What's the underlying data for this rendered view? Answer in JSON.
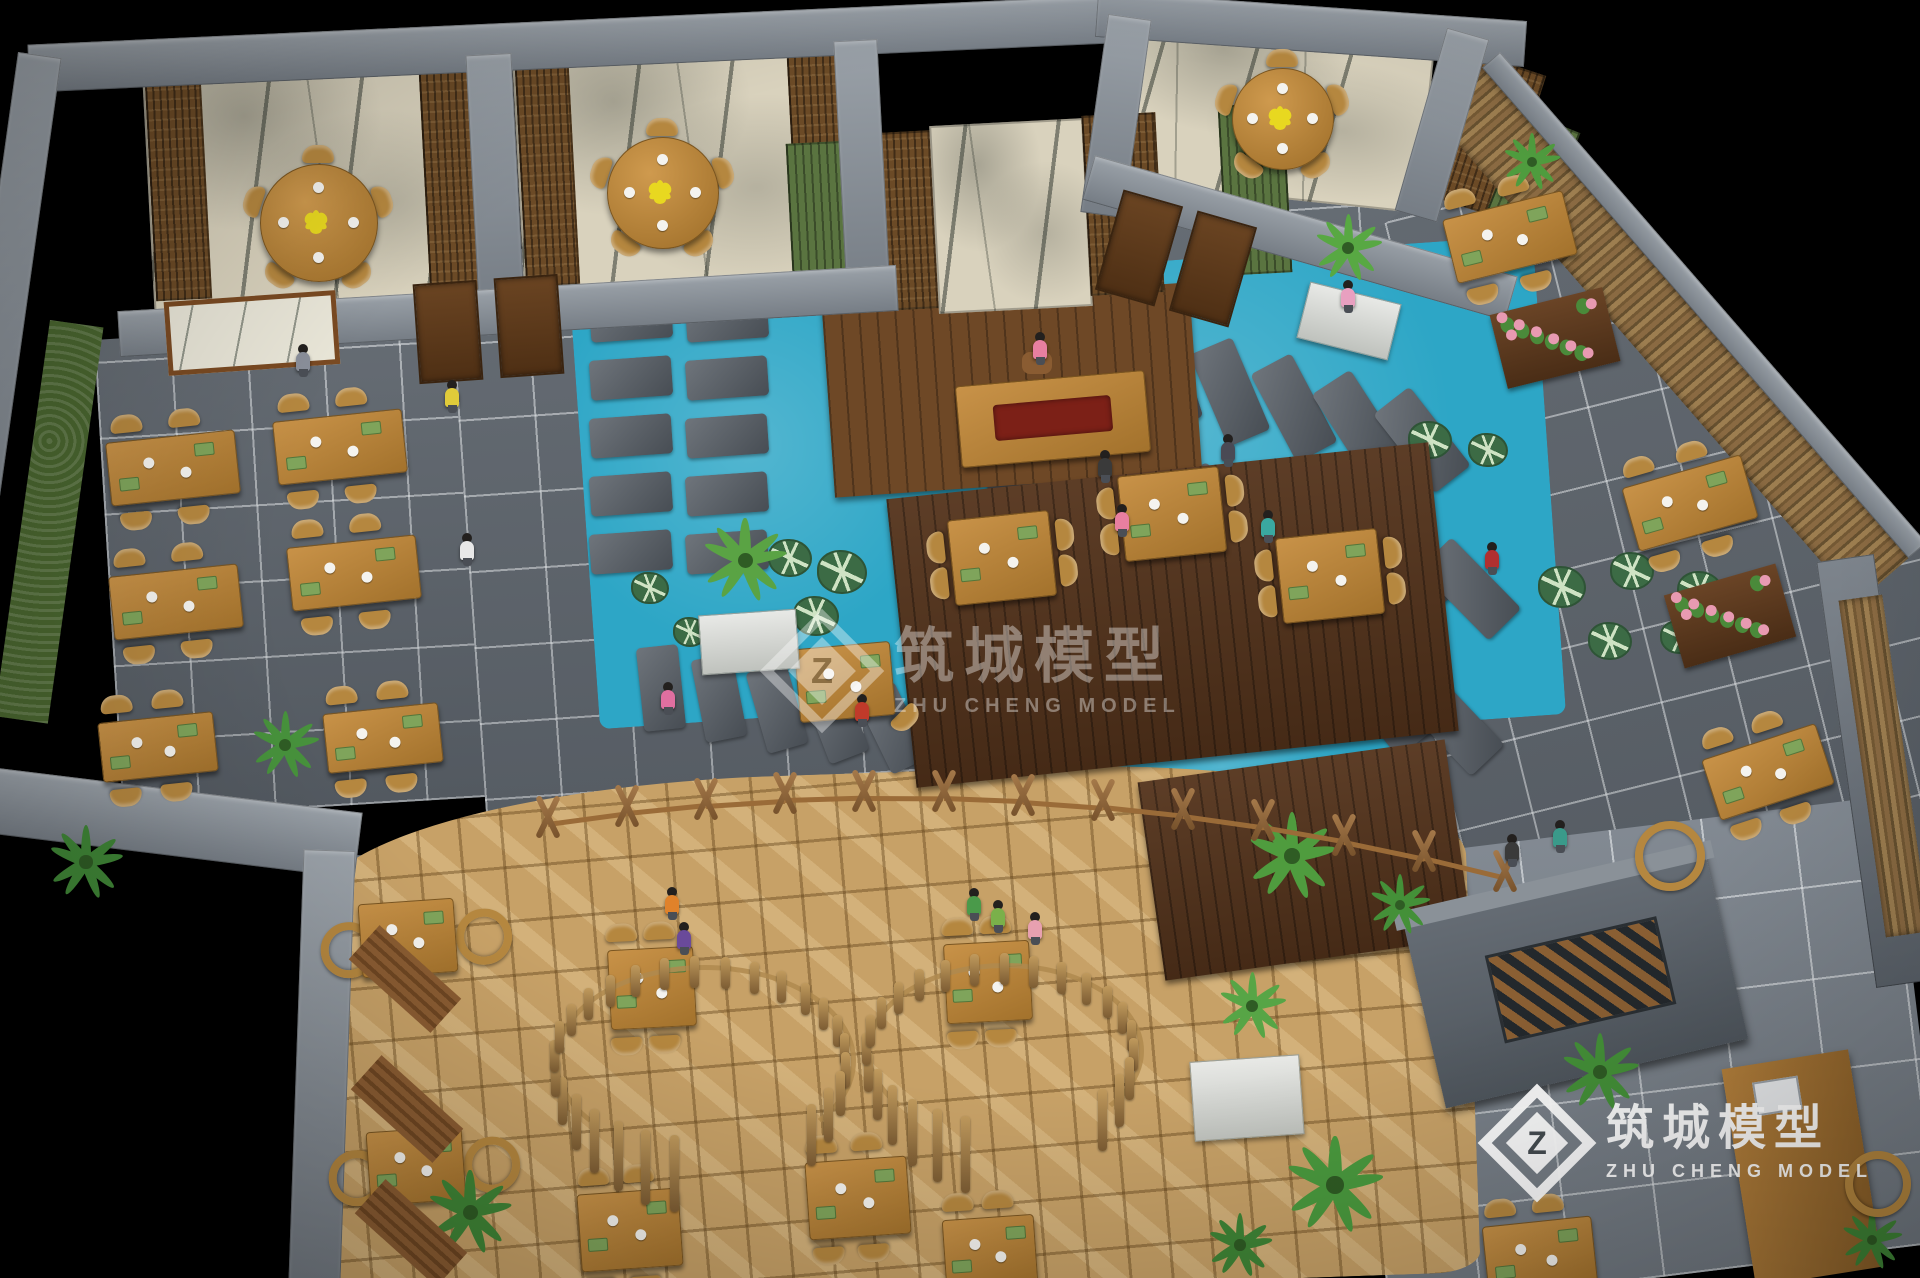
{
  "watermark": {
    "cn": "筑城模型",
    "en": "ZHU CHENG MODEL",
    "logo_glyph": "Z"
  },
  "colors": {
    "background": "#000000",
    "pond_water": "#2da6c6",
    "floor_tile": "#5c636b",
    "flagstone": "#c7a167",
    "deck_wood": "#54331b",
    "table_wood": "#c28e44",
    "wicker": "#b5873f",
    "wall_grey": "#8d949b",
    "art_wall_beige": "#d9d2bd",
    "carved_panel": "#6b4a26",
    "slat_green": "#5a7440",
    "flower_pink": "#e89ab2",
    "flower_yellow": "#e8d820",
    "plant_green": "#4f9c3e"
  },
  "scene": {
    "tables": [
      {
        "x": 173,
        "y": 468,
        "w": 130,
        "h": 64,
        "r": -6,
        "ch": "tb"
      },
      {
        "x": 340,
        "y": 447,
        "w": 130,
        "h": 64,
        "r": -6,
        "ch": "tb"
      },
      {
        "x": 176,
        "y": 602,
        "w": 130,
        "h": 64,
        "r": -6,
        "ch": "tb"
      },
      {
        "x": 354,
        "y": 573,
        "w": 130,
        "h": 64,
        "r": -6,
        "ch": "tb"
      },
      {
        "x": 158,
        "y": 747,
        "w": 116,
        "h": 60,
        "r": -6,
        "ch": "tb"
      },
      {
        "x": 383,
        "y": 738,
        "w": 116,
        "h": 60,
        "r": -6,
        "ch": "tb"
      },
      {
        "x": 845,
        "y": 682,
        "w": 96,
        "h": 74,
        "r": -5,
        "ch": "one"
      },
      {
        "x": 1002,
        "y": 558,
        "w": 102,
        "h": 86,
        "r": -6,
        "ch": "lr"
      },
      {
        "x": 1172,
        "y": 514,
        "w": 102,
        "h": 86,
        "r": -6,
        "ch": "lr"
      },
      {
        "x": 1330,
        "y": 576,
        "w": 102,
        "h": 86,
        "r": -6,
        "ch": "lr"
      },
      {
        "x": 1510,
        "y": 237,
        "w": 124,
        "h": 66,
        "r": -14,
        "ch": "tb"
      },
      {
        "x": 1690,
        "y": 503,
        "w": 124,
        "h": 66,
        "r": -16,
        "ch": "tb"
      },
      {
        "x": 1768,
        "y": 772,
        "w": 120,
        "h": 64,
        "r": -18,
        "ch": "tb"
      },
      {
        "x": 408,
        "y": 938,
        "w": 96,
        "h": 74,
        "r": -4,
        "ch": "ring"
      },
      {
        "x": 416,
        "y": 1166,
        "w": 96,
        "h": 74,
        "r": -4,
        "ch": "ring"
      },
      {
        "x": 630,
        "y": 1230,
        "w": 102,
        "h": 78,
        "r": -4,
        "ch": "tb"
      },
      {
        "x": 858,
        "y": 1198,
        "w": 102,
        "h": 78,
        "r": -4,
        "ch": "tb"
      },
      {
        "x": 990,
        "y": 1252,
        "w": 92,
        "h": 70,
        "r": -4,
        "ch": "tb"
      },
      {
        "x": 1540,
        "y": 1256,
        "w": 110,
        "h": 70,
        "r": -6,
        "ch": "tb"
      },
      {
        "x": 652,
        "y": 988,
        "w": 86,
        "h": 80,
        "r": -3,
        "ch": "tb"
      },
      {
        "x": 988,
        "y": 982,
        "w": 86,
        "h": 80,
        "r": -3,
        "ch": "tb"
      }
    ],
    "round_tables": [
      {
        "x": 318,
        "y": 222,
        "d": 116
      },
      {
        "x": 662,
        "y": 192,
        "d": 110
      },
      {
        "x": 1282,
        "y": 118,
        "d": 100
      }
    ],
    "stones": [
      {
        "kind": "grid",
        "x": 590,
        "y": 300,
        "cols": 2,
        "rows": 5,
        "dx": 96,
        "dy": 58,
        "w": 82,
        "h": 40,
        "r": -4
      },
      {
        "kind": "row",
        "x": 640,
        "y": 646,
        "n": 6,
        "dx": 58,
        "dy": 10,
        "w": 42,
        "h": 84,
        "r": -6,
        "dr": -5
      },
      {
        "kind": "row",
        "x": 1015,
        "y": 294,
        "n": 7,
        "dx": 64,
        "dy": 16,
        "w": 46,
        "h": 100,
        "r": -8,
        "dr": -5
      },
      {
        "kind": "row",
        "x": 985,
        "y": 413,
        "n": 8,
        "dx": 66,
        "dy": 18,
        "w": 46,
        "h": 100,
        "r": -6,
        "dr": -5.5
      },
      {
        "kind": "row",
        "x": 955,
        "y": 536,
        "n": 8,
        "dx": 68,
        "dy": 20,
        "w": 46,
        "h": 98,
        "r": -5,
        "dr": -5.5
      }
    ],
    "lily_clusters": [
      {
        "x": 788,
        "y": 556,
        "p": [
          [
            0,
            0,
            20
          ],
          [
            52,
            14,
            23
          ],
          [
            26,
            58,
            21
          ]
        ]
      },
      {
        "x": 1258,
        "y": 560,
        "p": [
          [
            0,
            0,
            21
          ],
          [
            64,
            20,
            24
          ],
          [
            10,
            62,
            22
          ]
        ]
      },
      {
        "x": 1428,
        "y": 438,
        "p": [
          [
            0,
            0,
            20
          ],
          [
            58,
            10,
            18
          ]
        ]
      },
      {
        "x": 1560,
        "y": 585,
        "p": [
          [
            0,
            0,
            22
          ],
          [
            70,
            -16,
            20
          ],
          [
            138,
            4,
            21
          ],
          [
            48,
            54,
            20
          ],
          [
            118,
            50,
            18
          ]
        ]
      },
      {
        "x": 648,
        "y": 586,
        "p": [
          [
            0,
            0,
            17
          ],
          [
            40,
            44,
            15
          ]
        ]
      }
    ],
    "plants": [
      {
        "x": 745,
        "y": 560,
        "s": 1.25,
        "c": "#5aa344"
      },
      {
        "x": 1348,
        "y": 248,
        "s": 1.0,
        "c": "#58a843"
      },
      {
        "x": 1292,
        "y": 856,
        "s": 1.3,
        "c": "#4f9c3e"
      },
      {
        "x": 1252,
        "y": 1006,
        "s": 1.0,
        "c": "#57a546"
      },
      {
        "x": 470,
        "y": 1212,
        "s": 1.25,
        "c": "#3f8536"
      },
      {
        "x": 285,
        "y": 745,
        "s": 1.0,
        "c": "#47923c"
      },
      {
        "x": 86,
        "y": 862,
        "s": 1.1,
        "c": "#3f8536"
      },
      {
        "x": 1335,
        "y": 1185,
        "s": 1.45,
        "c": "#4a9a3e"
      },
      {
        "x": 1600,
        "y": 1072,
        "s": 1.15,
        "c": "#449038"
      },
      {
        "x": 1400,
        "y": 905,
        "s": 0.9,
        "c": "#449038"
      },
      {
        "x": 1240,
        "y": 1245,
        "s": 0.95,
        "c": "#3f8536"
      },
      {
        "x": 1532,
        "y": 162,
        "s": 0.85,
        "c": "#4f9c3e"
      },
      {
        "x": 1872,
        "y": 1240,
        "s": 0.9,
        "c": "#3f8536"
      }
    ],
    "planters_white": [
      {
        "x": 700,
        "y": 612,
        "w": 96,
        "h": 58,
        "r": -4
      },
      {
        "x": 1302,
        "y": 292,
        "w": 92,
        "h": 56,
        "r": 14
      },
      {
        "x": 1192,
        "y": 1058,
        "w": 108,
        "h": 78,
        "r": -4
      }
    ],
    "flower_planters": [
      {
        "x": 1497,
        "y": 300,
        "w": 116,
        "h": 76,
        "r": -14
      },
      {
        "x": 1672,
        "y": 578,
        "w": 116,
        "h": 76,
        "r": -16
      }
    ],
    "people": [
      {
        "x": 1040,
        "y": 348,
        "c": "#e87fa0"
      },
      {
        "x": 303,
        "y": 360,
        "c": "#8a8f9a"
      },
      {
        "x": 452,
        "y": 396,
        "c": "#e0cb3a"
      },
      {
        "x": 467,
        "y": 549,
        "c": "#e8e8e8"
      },
      {
        "x": 668,
        "y": 698,
        "c": "#e06fa0"
      },
      {
        "x": 862,
        "y": 710,
        "c": "#c03a2a"
      },
      {
        "x": 1105,
        "y": 466,
        "c": "#3a3a3a"
      },
      {
        "x": 1122,
        "y": 520,
        "c": "#e87fa0"
      },
      {
        "x": 1268,
        "y": 526,
        "c": "#3aa8a0"
      },
      {
        "x": 1228,
        "y": 450,
        "c": "#4a4a55"
      },
      {
        "x": 974,
        "y": 904,
        "c": "#4a9a4a"
      },
      {
        "x": 672,
        "y": 903,
        "c": "#e0822a"
      },
      {
        "x": 684,
        "y": 938,
        "c": "#6a4a9a"
      },
      {
        "x": 1035,
        "y": 928,
        "c": "#e8a0b0"
      },
      {
        "x": 998,
        "y": 916,
        "c": "#7ab04a"
      },
      {
        "x": 1492,
        "y": 558,
        "c": "#b03030"
      },
      {
        "x": 1560,
        "y": 836,
        "c": "#3a9a8a"
      },
      {
        "x": 1348,
        "y": 296,
        "c": "#e8a0c0"
      },
      {
        "x": 1512,
        "y": 850,
        "c": "#3a3a3a"
      }
    ],
    "fence": {
      "x0": 548,
      "y0": 816,
      "cx": 1020,
      "cy": 744,
      "x1": 1505,
      "y1": 870,
      "n": 13
    },
    "booths": [
      {
        "cx": 700,
        "cy": 1056,
        "r": 146,
        "a0": 100,
        "a1": 400,
        "n": 26
      },
      {
        "cx": 1000,
        "cy": 1046,
        "r": 134,
        "a0": 105,
        "a1": 400,
        "n": 24
      }
    ],
    "rings": [
      {
        "x": 1662,
        "y": 848,
        "d": 54
      },
      {
        "x": 1870,
        "y": 1176,
        "d": 50
      }
    ],
    "mats": [
      {
        "x": 350,
        "y": 956
      },
      {
        "x": 352,
        "y": 1086
      },
      {
        "x": 356,
        "y": 1210
      }
    ]
  }
}
